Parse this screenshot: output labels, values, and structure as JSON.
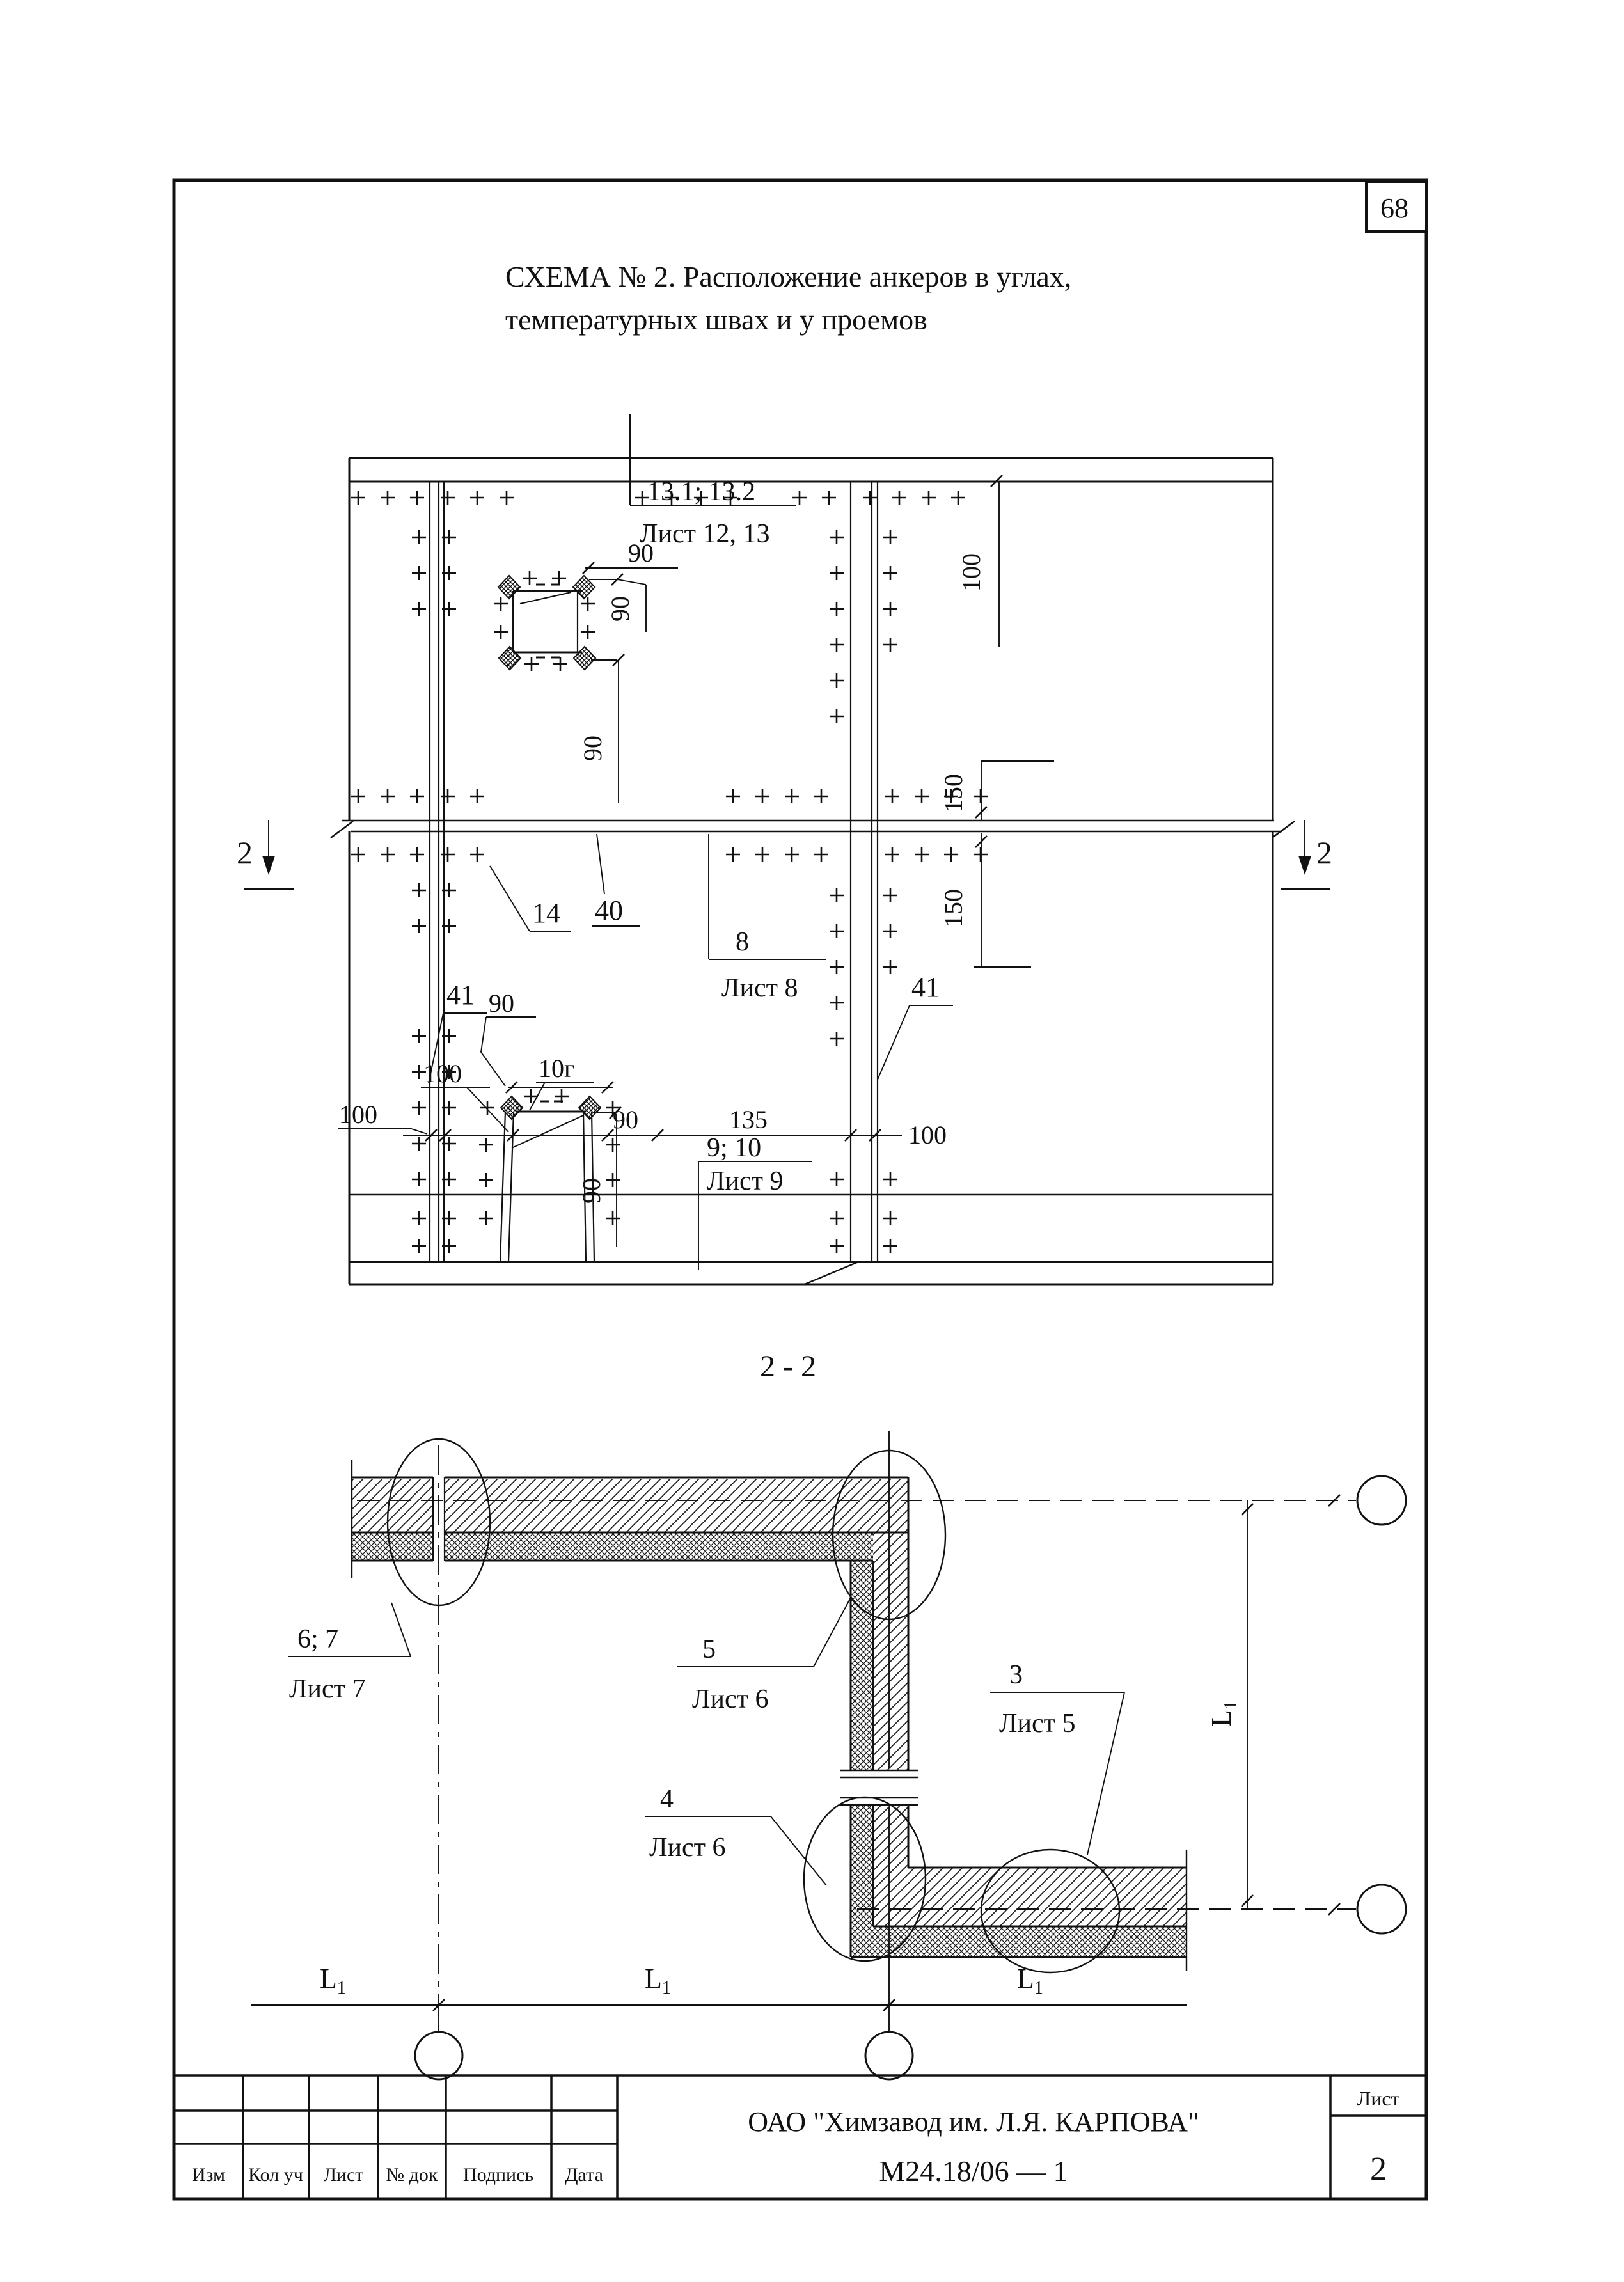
{
  "page": {
    "number": "68"
  },
  "title": {
    "line1": "СХЕМА № 2. Расположение анкеров в углах,",
    "line2": "температурных швах и у проемов"
  },
  "section_label": "2 - 2",
  "dims": {
    "n90": "90",
    "n100": "100",
    "n150": "150",
    "n135": "135",
    "n40": "40",
    "n14": "14",
    "n41": "41",
    "n8": "8",
    "n2": "2",
    "n10g": "10г",
    "n13": "13.1; 13.2",
    "sheet1213": "Лист 12, 13",
    "sheet8": "Лист 8",
    "n910": "9; 10",
    "sheet9": "Лист 9",
    "L": "L",
    "sub1": "1"
  },
  "callouts": {
    "c67": "6; 7",
    "sheet7": "Лист 7",
    "c5": "5",
    "sheet6": "Лист 6",
    "c4": "4",
    "c3": "3",
    "sheet5": "Лист 5"
  },
  "title_block": {
    "columns": [
      "Изм",
      "Кол уч",
      "Лист",
      "№ док",
      "Подпись",
      "Дата"
    ],
    "organization": "ОАО \"Химзавод им. Л.Я. КАРПОВА\"",
    "document": "М24.18/06 — 1",
    "sheet_label": "Лист",
    "sheet_number": "2"
  }
}
